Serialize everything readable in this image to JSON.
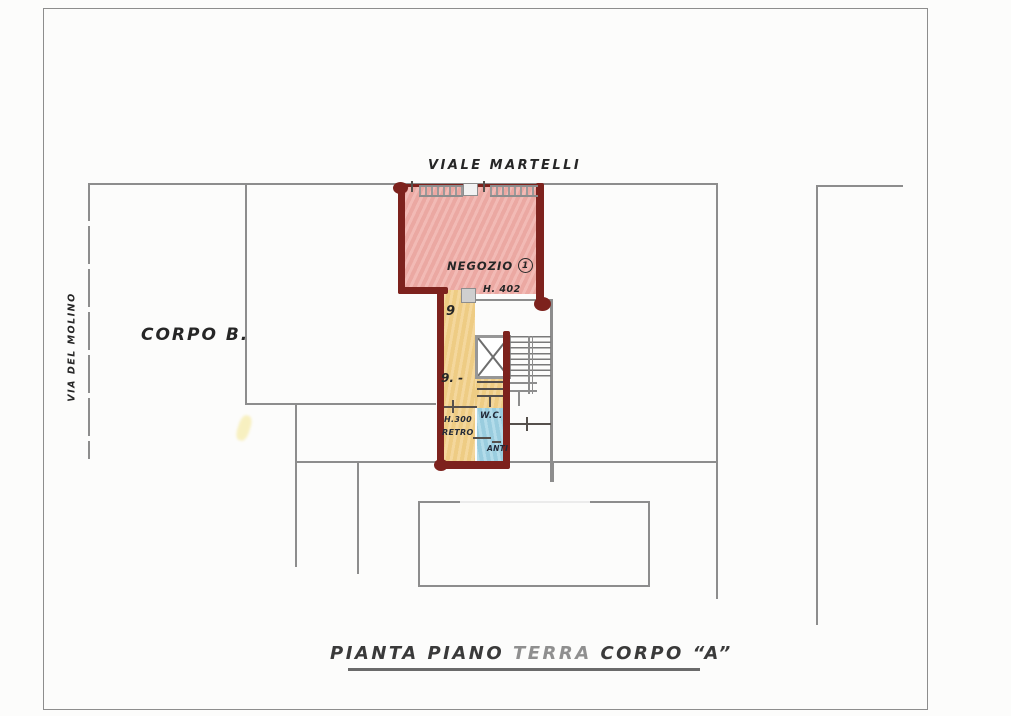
{
  "labels": {
    "street_top": "VIALE MARTELLI",
    "street_left": "VIA DEL MOLINO",
    "corpo_b": "CORPO B.",
    "negozio": "NEGOZIO",
    "negozio_badge": "1",
    "negozio_height": "H. 402",
    "mark_upper": "9",
    "mark_lower": "9. -",
    "retro_height": "H.300",
    "retro": "RETRO",
    "wc": "W.C.",
    "anti": "ANTI"
  },
  "title": {
    "part1": "PIANTA PIANO",
    "part2": "TERRA",
    "part3": "CORPO “A”"
  },
  "colors": {
    "wall_maroon": "#7d221d",
    "shop_fill": "#f0b2ad",
    "corridor_fill": "#f2d28f",
    "wc_fill": "#a7d6e6",
    "line_gray": "#8d8d8d",
    "ink": "#262626",
    "title_ink": "#3a3a3a",
    "terra_ink": "#8f8f8f",
    "paper": "#fcfcfb"
  }
}
